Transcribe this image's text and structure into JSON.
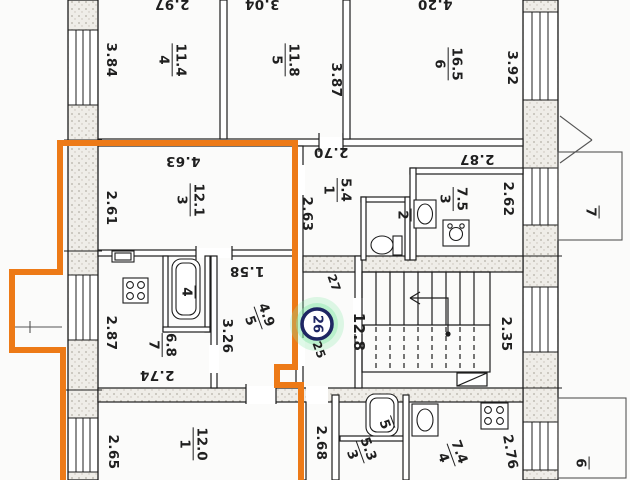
{
  "plan_title": "Apartment building floor plan, flat 26 outlined",
  "colors": {
    "highlight_outline": "#ed7a17",
    "badge_ring": "#1e2663",
    "badge_halo": "#8ce8ac"
  },
  "rooms": [
    {
      "number": "4",
      "area": "11.4"
    },
    {
      "number": "5",
      "area": "11.8"
    },
    {
      "number": "6",
      "area": "16.5"
    },
    {
      "number": "3",
      "area": "12.1"
    },
    {
      "number": "1",
      "area": "5.4"
    },
    {
      "number": "2",
      "area": ""
    },
    {
      "number": "3",
      "area": "7.5"
    },
    {
      "number": "7",
      "area": "6.8"
    },
    {
      "number": "4",
      "area": ""
    },
    {
      "number": "5",
      "area": "4.9"
    },
    {
      "number": "1",
      "area": "12.0"
    },
    {
      "number": "3",
      "area": "5.3"
    },
    {
      "number": "5",
      "area": ""
    },
    {
      "number": "4",
      "area": "7.4"
    }
  ],
  "dims": [
    "2.97",
    "3.04",
    "4.20",
    "3.84",
    "3.87",
    "3.92",
    "4.63",
    "2.61",
    "2.63",
    "2.70",
    "2.87",
    "2.62",
    "2.87",
    "1.58",
    "3.26",
    "2.74",
    "2.35",
    "2.65",
    "2.68",
    "2.76"
  ],
  "stairwell": {
    "area": "12.8"
  },
  "badges": {
    "selected": "26",
    "above": "27",
    "below": "25"
  },
  "balconies": {
    "right": "7",
    "bottom": "6"
  }
}
